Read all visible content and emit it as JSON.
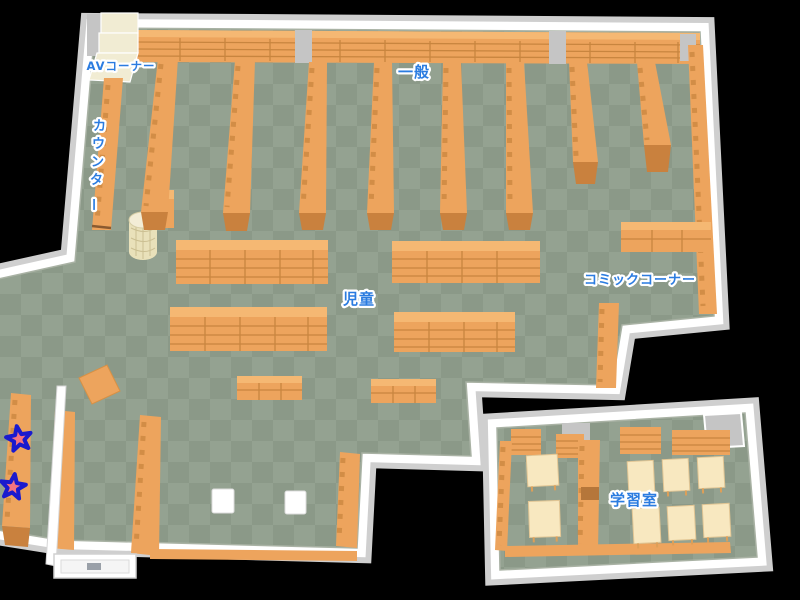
{
  "map": {
    "type": "library-floor-map",
    "labels": {
      "av_corner": "AVコーナー",
      "counter": "カウンター",
      "general": "一般",
      "children": "児童",
      "comic_corner": "コミックコーナー",
      "study_room": "学習室"
    },
    "markers": {
      "icon": "star-marker",
      "count": 2
    }
  },
  "colors": {
    "background": "#000000",
    "floor_dark": "#8b9988",
    "floor_light": "#94a291",
    "shelf": "#eda45d",
    "shelf_top": "#f5b873",
    "shelf_line": "#c8853f",
    "shelf_cap": "#c9813e",
    "shelf_gap_dark": "#b5763a",
    "desk": "#f8e8c0",
    "av": "#f1ecd3",
    "cylinder": "#e9e1ba",
    "wall": "#ffffff",
    "wall_shade": "#cfcfcf",
    "pillar_gray": "#c5c5c5",
    "label": "#2b7ce0",
    "halo": "#ffffff",
    "star_fill": "#f4737f",
    "star_outline": "#1a1ace"
  }
}
